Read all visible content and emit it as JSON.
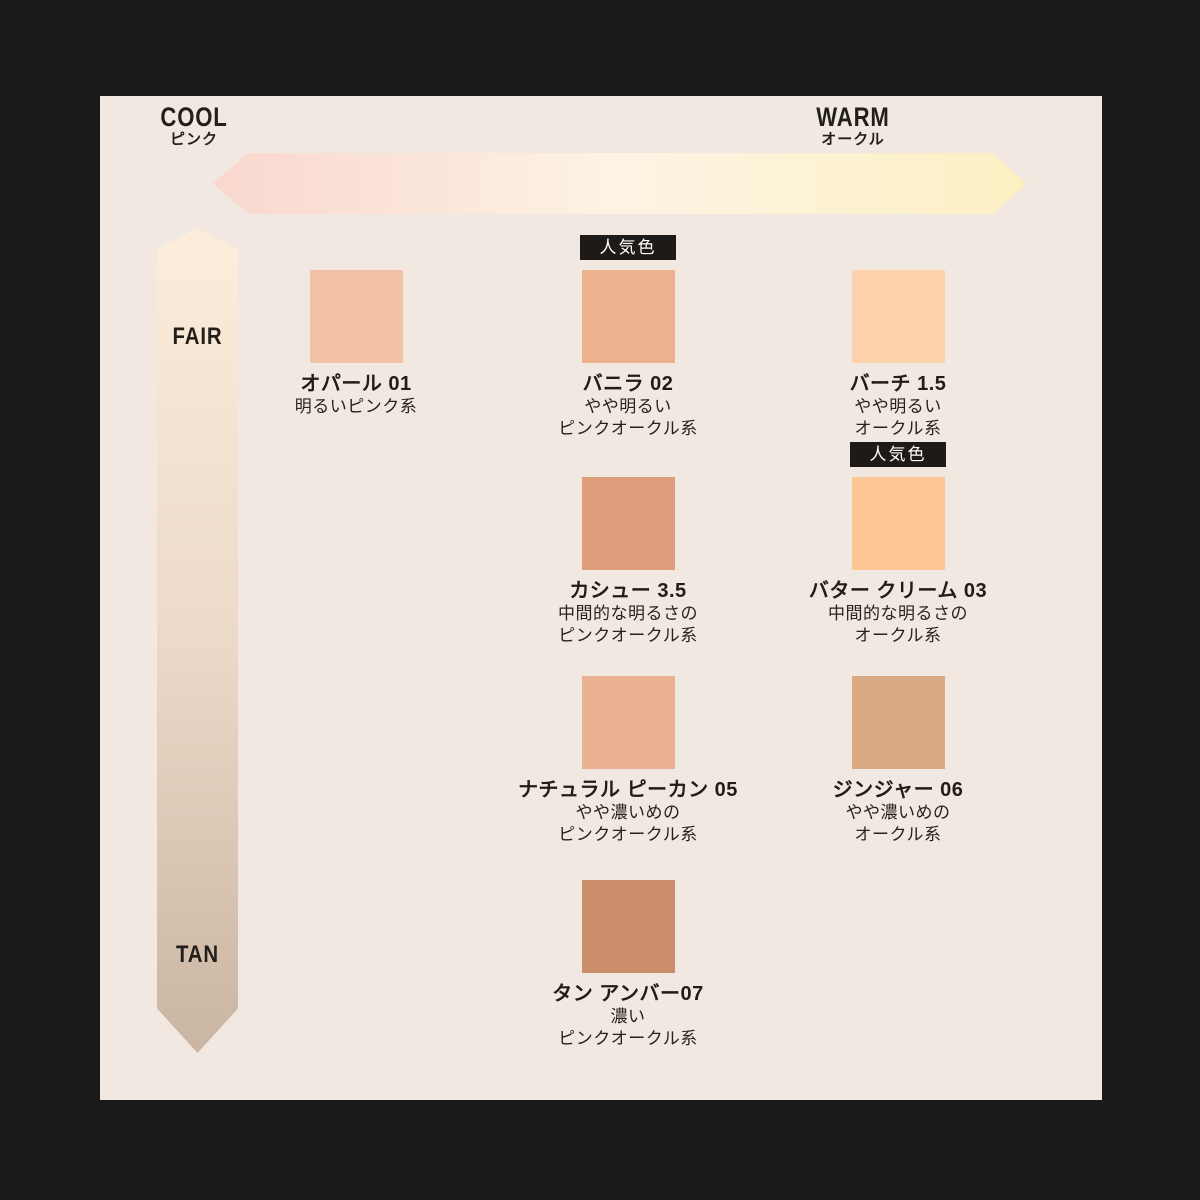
{
  "badge_label": "人気色",
  "colors": {
    "background": "#1c1a18",
    "panel": "#f1e9e1",
    "badge_bg": "#1e1a17",
    "badge_text": "#ffffff",
    "text": "#221f1b"
  },
  "axes": {
    "horizontal": {
      "left_label": "COOL",
      "left_sublabel": "ピンク",
      "right_label": "WARM",
      "right_sublabel": "オークル",
      "gradient": [
        "#f9d7ce",
        "#fdf3e4",
        "#fcf0c2"
      ]
    },
    "vertical": {
      "top_label": "FAIR",
      "bottom_label": "TAN",
      "gradient": [
        "#fdeddb",
        "#ecd9c7",
        "#cab5a2"
      ]
    }
  },
  "shades": [
    {
      "id": "opal-01",
      "name": "オパール 01",
      "color": "#f1c2a6",
      "popular": false,
      "description_lines": [
        "明るいピンク系"
      ]
    },
    {
      "id": "vanilla-02",
      "name": "バニラ 02",
      "color": "#ecb28e",
      "popular": true,
      "description_lines": [
        "やや明るい",
        "ピンクオークル系"
      ]
    },
    {
      "id": "birch-1-5",
      "name": "バーチ 1.5",
      "color": "#fdd3ae",
      "popular": false,
      "description_lines": [
        "やや明るい",
        "オークル系"
      ]
    },
    {
      "id": "cashew-3-5",
      "name": "カシュー 3.5",
      "color": "#dd9d7a",
      "popular": false,
      "description_lines": [
        "中間的な明るさの",
        "ピンクオークル系"
      ]
    },
    {
      "id": "butter-cream-03",
      "name": "バター クリーム 03",
      "color": "#fcc795",
      "popular": true,
      "description_lines": [
        "中間的な明るさの",
        "オークル系"
      ]
    },
    {
      "id": "natural-pecan-05",
      "name": "ナチュラル ピーカン 05",
      "color": "#eab092",
      "popular": false,
      "description_lines": [
        "やや濃いめの",
        "ピンクオークル系"
      ]
    },
    {
      "id": "ginger-06",
      "name": "ジンジャー 06",
      "color": "#d9aa83",
      "popular": false,
      "description_lines": [
        "やや濃いめの",
        "オークル系"
      ]
    },
    {
      "id": "tan-amber-07",
      "name": "タン アンバー07",
      "color": "#cb8e6a",
      "popular": false,
      "description_lines": [
        "濃い",
        "ピンクオークル系"
      ]
    }
  ]
}
